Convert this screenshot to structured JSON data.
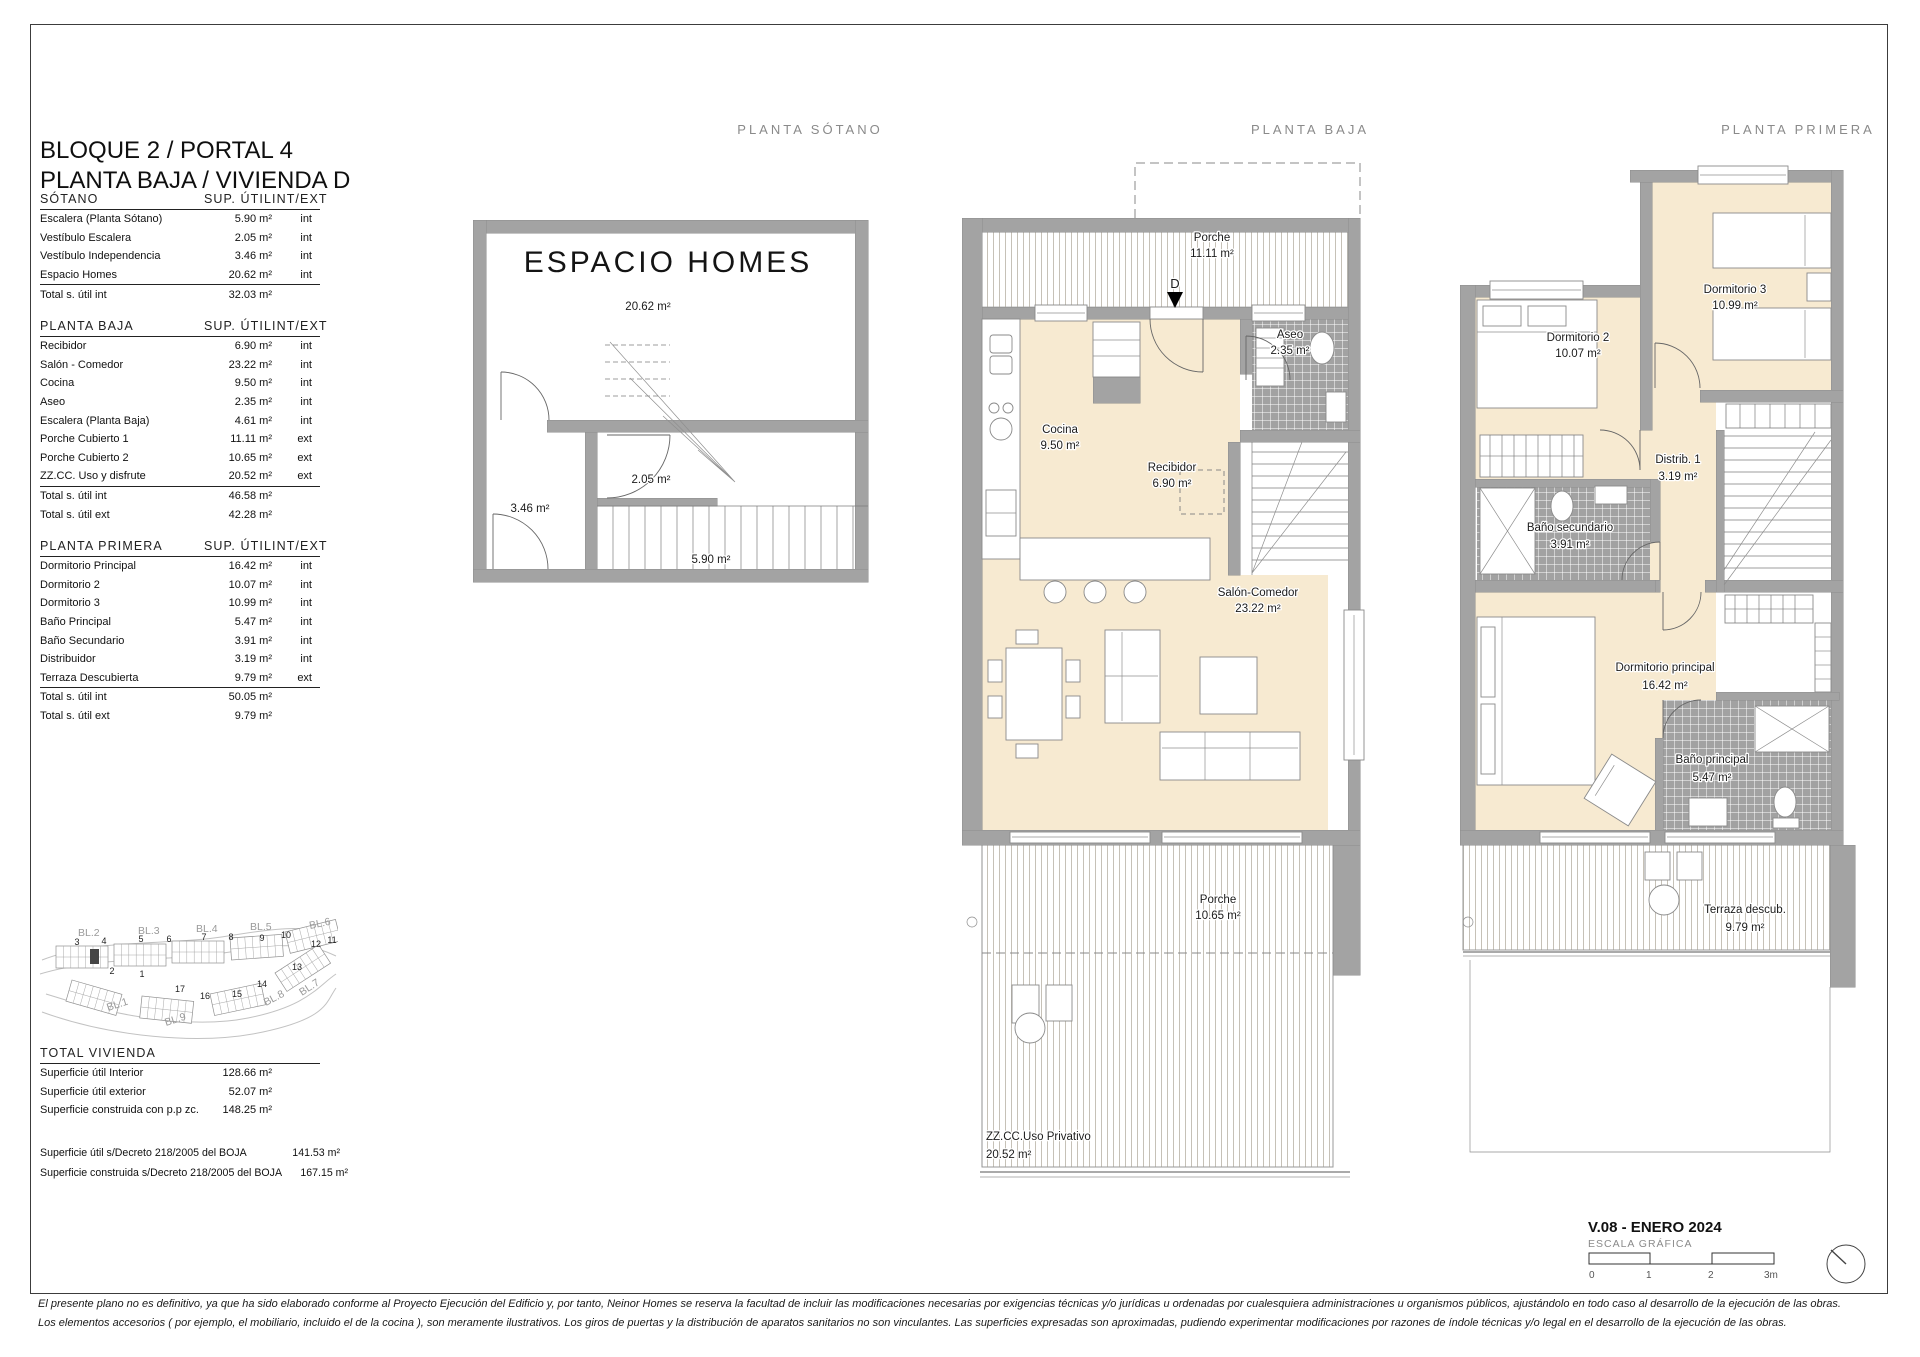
{
  "page": {
    "title_line1": "BLOQUE 2 / PORTAL 4",
    "title_line2": "PLANTA BAJA / VIVIENDA D",
    "version": "V.08 - ENERO 2024",
    "scale_label": "ESCALA GRÁFICA",
    "scale_ticks": [
      "0",
      "1",
      "2",
      "3m"
    ],
    "footer_line1": "El presente plano no es definitivo, ya que ha sido elaborado conforme al Proyecto Ejecución del Edificio y, por tanto, Neinor Homes se reserva la facultad de incluir las modificaciones necesarias por exigencias técnicas y/o jurídicas u ordenadas por cualesquiera administraciones u organismos públicos, ajustándolo en todo caso al desarrollo de la ejecución de las obras.",
    "footer_line2": "Los elementos accesorios  ( por ejemplo, el mobiliario, incluido el de la cocina ),  son meramente ilustrativos.  Los giros de puertas  y  la distribución de aparatos sanitarios no son vinculantes.  Las superficies  expresadas son aproximadas,  pudiendo  experimentar modificaciones por razones de índole técnicas y/o legal en el desarrollo de la ejecución de las obras."
  },
  "colors": {
    "room_cream": "#f7ead1",
    "wall_gray": "#a3a3a3",
    "tile_gray": "#a2a2a2",
    "hatch_line": "#c6c1b7"
  },
  "plan_headers": {
    "sotano": "PLANTA SÓTANO",
    "baja": "PLANTA BAJA",
    "primera": "PLANTA PRIMERA"
  },
  "tables": {
    "headers": {
      "sup": "SUP. ÚTIL",
      "intext": "INT/EXT"
    },
    "sotano": {
      "title": "SÓTANO",
      "rows": [
        {
          "label": "Escalera (Planta Sótano)",
          "value": "5.90 m²",
          "type": "int"
        },
        {
          "label": "Vestíbulo Escalera",
          "value": "2.05 m²",
          "type": "int"
        },
        {
          "label": "Vestíbulo Independencia",
          "value": "3.46 m²",
          "type": "int"
        },
        {
          "label": "Espacio Homes",
          "value": "20.62 m²",
          "type": "int"
        }
      ],
      "totals": [
        {
          "label": "Total s. útil int",
          "value": "32.03 m²"
        }
      ]
    },
    "baja": {
      "title": "PLANTA BAJA",
      "rows": [
        {
          "label": "Recibidor",
          "value": "6.90 m²",
          "type": "int"
        },
        {
          "label": "Salón - Comedor",
          "value": "23.22 m²",
          "type": "int"
        },
        {
          "label": "Cocina",
          "value": "9.50 m²",
          "type": "int"
        },
        {
          "label": "Aseo",
          "value": "2.35 m²",
          "type": "int"
        },
        {
          "label": "Escalera (Planta Baja)",
          "value": "4.61 m²",
          "type": "int"
        },
        {
          "label": "Porche Cubierto 1",
          "value": "11.11 m²",
          "type": "ext"
        },
        {
          "label": "Porche Cubierto 2",
          "value": "10.65 m²",
          "type": "ext"
        },
        {
          "label": "ZZ.CC. Uso y disfrute",
          "value": "20.52 m²",
          "type": "ext"
        }
      ],
      "totals": [
        {
          "label": "Total s. útil int",
          "value": "46.58 m²"
        },
        {
          "label": "Total s. útil ext",
          "value": "42.28 m²"
        }
      ]
    },
    "primera": {
      "title": "PLANTA PRIMERA",
      "rows": [
        {
          "label": "Dormitorio Principal",
          "value": "16.42 m²",
          "type": "int"
        },
        {
          "label": "Dormitorio 2",
          "value": "10.07 m²",
          "type": "int"
        },
        {
          "label": "Dormitorio 3",
          "value": "10.99 m²",
          "type": "int"
        },
        {
          "label": "Baño Principal",
          "value": "5.47 m²",
          "type": "int"
        },
        {
          "label": "Baño Secundario",
          "value": "3.91 m²",
          "type": "int"
        },
        {
          "label": "Distribuidor",
          "value": "3.19 m²",
          "type": "int"
        },
        {
          "label": "Terraza Descubierta",
          "value": "9.79 m²",
          "type": "ext"
        }
      ],
      "totals": [
        {
          "label": "Total s. útil int",
          "value": "50.05 m²"
        },
        {
          "label": "Total s. útil ext",
          "value": "9.79 m²"
        }
      ]
    },
    "total": {
      "title": "TOTAL VIVIENDA",
      "rows": [
        {
          "label": "Superficie útil Interior",
          "value": "128.66 m²"
        },
        {
          "label": "Superficie útil exterior",
          "value": "52.07 m²"
        },
        {
          "label": "Superficie construida con p.p zc.",
          "value": "148.25 m²"
        }
      ],
      "decreto": [
        {
          "label": "Superficie útil s/Decreto 218/2005 del BOJA",
          "value": "141.53 m²"
        },
        {
          "label": "Superficie construida s/Decreto 218/2005 del BOJA",
          "value": "167.15 m²"
        }
      ]
    }
  },
  "plans": {
    "sotano": {
      "big_label": "ESPACIO HOMES",
      "areas": {
        "espacio": "20.62 m²",
        "vestibulo_independencia": "3.46 m²",
        "vestibulo_escalera": "2.05 m²",
        "escalera": "5.90 m²"
      }
    },
    "baja": {
      "entry_marker": "D",
      "porche1": {
        "name": "Porche",
        "area": "11.11 m²"
      },
      "aseo": {
        "name": "Aseo",
        "area": "2.35 m²"
      },
      "cocina": {
        "name": "Cocina",
        "area": "9.50 m²"
      },
      "recibidor": {
        "name": "Recibidor",
        "area": "6.90 m²"
      },
      "salon": {
        "name": "Salón-Comedor",
        "area": "23.22 m²"
      },
      "porche2": {
        "name": "Porche",
        "area": "10.65 m²"
      },
      "zzcc": {
        "name": "ZZ.CC.Uso Privativo",
        "area": "20.52 m²"
      }
    },
    "primera": {
      "dorm2": {
        "name": "Dormitorio 2",
        "area": "10.07 m²"
      },
      "dorm3": {
        "name": "Dormitorio 3",
        "area": "10.99 m²"
      },
      "distrib": {
        "name": "Distrib. 1",
        "area": "3.19 m²"
      },
      "bano_sec": {
        "name": "Baño secundario",
        "area": "3.91 m²"
      },
      "dorm_ppal": {
        "name": "Dormitorio principal",
        "area": "16.42 m²"
      },
      "bano_ppal": {
        "name": "Baño principal",
        "area": "5.47 m²"
      },
      "terraza": {
        "name": "Terraza descub.",
        "area": "9.79 m²"
      }
    }
  },
  "sitemap": {
    "blocks": [
      "BL.2",
      "BL.3",
      "BL.4",
      "BL.5",
      "BL.6",
      "BL.1",
      "BL.9",
      "BL.8",
      "BL.7"
    ],
    "numbers": [
      "3",
      "4",
      "5",
      "6",
      "7",
      "8",
      "9",
      "10",
      "11",
      "12",
      "2",
      "1",
      "17",
      "16",
      "15",
      "14",
      "13"
    ]
  }
}
